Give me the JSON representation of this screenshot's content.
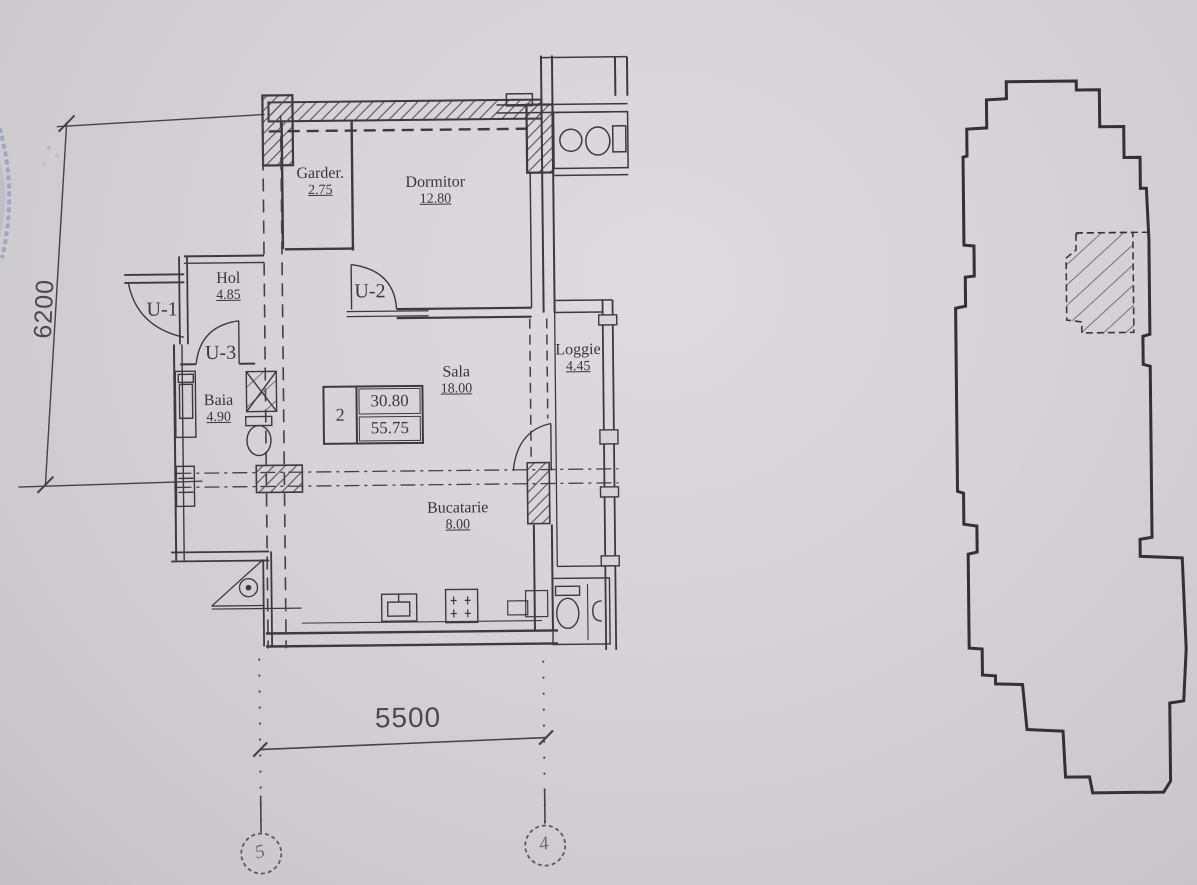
{
  "drawing": {
    "type": "apartment-floor-plan-scan",
    "colors": {
      "paper": "#d6d3d6",
      "ink": "#3c3a3c",
      "stamp_blue": "#5a6aa8"
    }
  },
  "rooms": [
    {
      "name": "Garder.",
      "area": "2.75"
    },
    {
      "name": "Dormitor",
      "area": "12.80"
    },
    {
      "name": "Hol",
      "area": "4.85"
    },
    {
      "name": "Baia",
      "area": "4.90"
    },
    {
      "name": "Sala",
      "area": "18.00"
    },
    {
      "name": "Loggie",
      "area": "4.45"
    },
    {
      "name": "Bucatarie",
      "area": "8.00"
    }
  ],
  "doors": {
    "u1": "U-1",
    "u2": "U-2",
    "u3": "U-3"
  },
  "area_table": {
    "apartment_number": "2",
    "living_area": "30.80",
    "total_area": "55.75"
  },
  "dimensions": {
    "horizontal": "5500",
    "vertical": "6200"
  },
  "grid_axes": {
    "left": "5",
    "right": "4"
  }
}
